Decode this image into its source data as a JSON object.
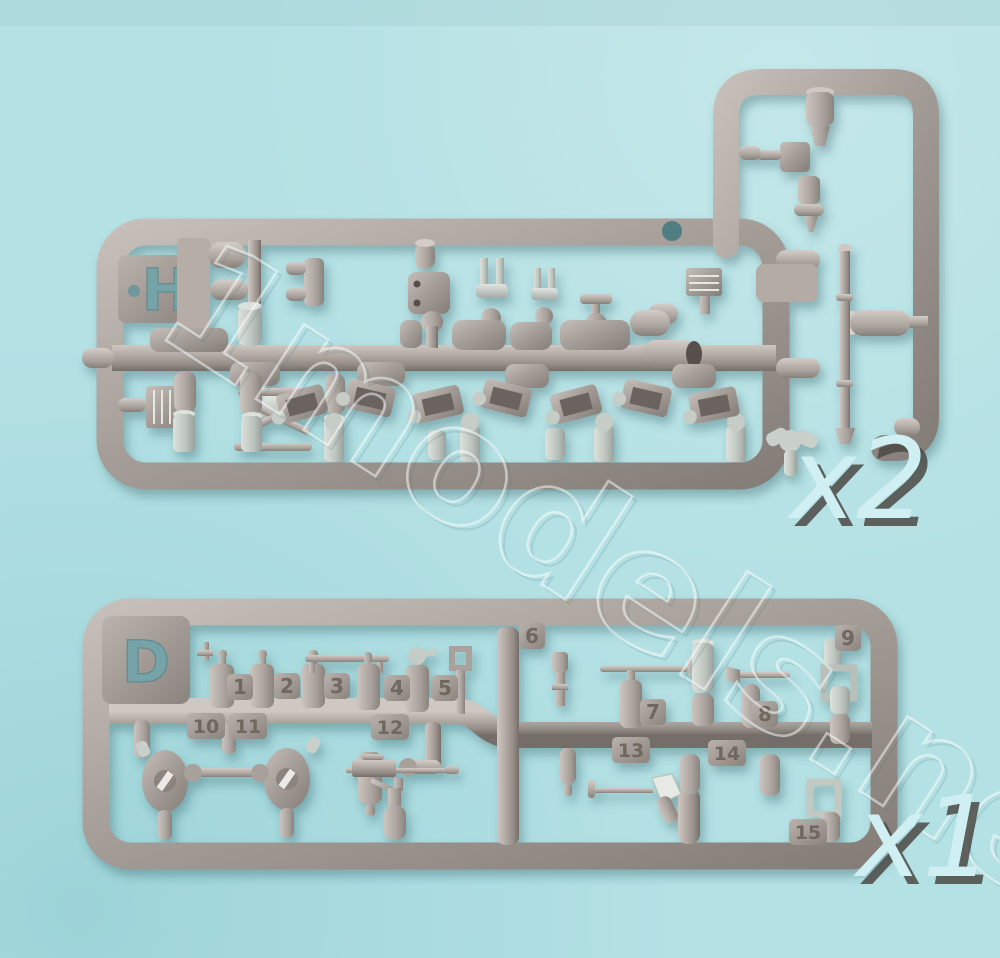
{
  "photo": {
    "background_color": "#b4e1e4",
    "plastic_color": "#a8a09b",
    "pale_part_color": "#c9cfc9",
    "quantity_text_color": "#cfeff3"
  },
  "watermark": {
    "text": "1models.net"
  },
  "sprue_h": {
    "letter": "H",
    "quantity": "x2"
  },
  "sprue_d": {
    "letter": "D",
    "quantity": "x1",
    "part_numbers": [
      "1",
      "2",
      "3",
      "4",
      "5",
      "6",
      "7",
      "8",
      "9",
      "10",
      "11",
      "12",
      "13",
      "14",
      "15"
    ]
  }
}
